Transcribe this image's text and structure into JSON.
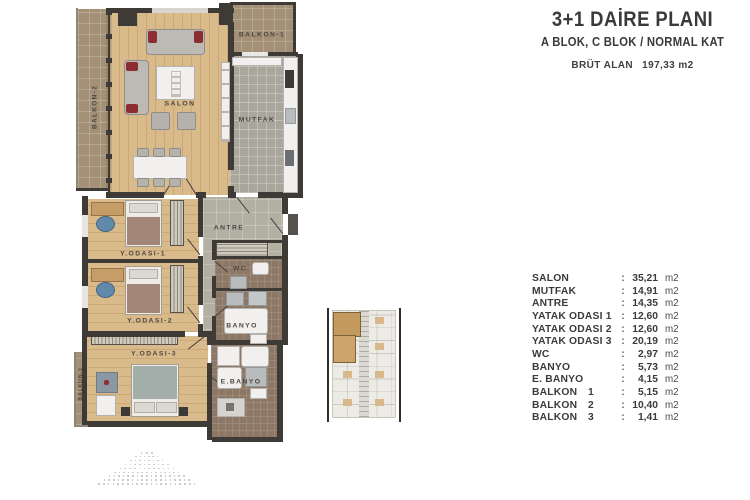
{
  "header": {
    "title": "3+1 DAİRE PLANI",
    "subtitle": "A BLOK, C BLOK / NORMAL KAT",
    "area_label": "BRÜT ALAN",
    "area_value": "197,33 m2"
  },
  "plan": {
    "labels": {
      "salon": "SALON",
      "mutfak": "MUTFAK",
      "antre": "ANTRE",
      "balkon1": "BALKON-1",
      "balkon2": "BALKON-2",
      "balkon3": "BALKON-3",
      "yodasi1": "Y.ODASI-1",
      "yodasi2": "Y.ODASI-2",
      "yodasi3": "Y.ODASI-3",
      "wc": "WC",
      "banyo": "BANYO",
      "ebanyo": "E.BANYO"
    }
  },
  "area_table": {
    "separator": ":",
    "rows": [
      {
        "name": "SALON",
        "num": "",
        "value": "35,21",
        "unit": "m2"
      },
      {
        "name": "MUTFAK",
        "num": "",
        "value": "14,91",
        "unit": "m2"
      },
      {
        "name": "ANTRE",
        "num": "",
        "value": "14,35",
        "unit": "m2"
      },
      {
        "name": "YATAK ODASI 1",
        "num": "",
        "value": "12,60",
        "unit": "m2"
      },
      {
        "name": "YATAK ODASI 2",
        "num": "",
        "value": "12,60",
        "unit": "m2"
      },
      {
        "name": "YATAK ODASI 3",
        "num": "",
        "value": "20,19",
        "unit": "m2"
      },
      {
        "name": "WC",
        "num": "",
        "value": "2,97",
        "unit": "m2"
      },
      {
        "name": "BANYO",
        "num": "",
        "value": "5,73",
        "unit": "m2"
      },
      {
        "name": "E. BANYO",
        "num": "",
        "value": "4,15",
        "unit": "m2"
      },
      {
        "name": "BALKON",
        "num": "1",
        "value": "5,15",
        "unit": "m2"
      },
      {
        "name": "BALKON",
        "num": "2",
        "value": "10,40",
        "unit": "m2"
      },
      {
        "name": "BALKON",
        "num": "3",
        "value": "1,41",
        "unit": "m2"
      }
    ]
  },
  "colors": {
    "wall": "#3e3a36",
    "wood_floor": "#d9ba8a",
    "balcony_tile": "#a39076",
    "bath_tile": "#8d7866",
    "antre_tile": "#b2b0a3",
    "kitchen_tile": "#a9a79c",
    "accent_red": "#8c2e31",
    "keyplan_highlight": "#c4995e",
    "text": "#3b3a39"
  }
}
